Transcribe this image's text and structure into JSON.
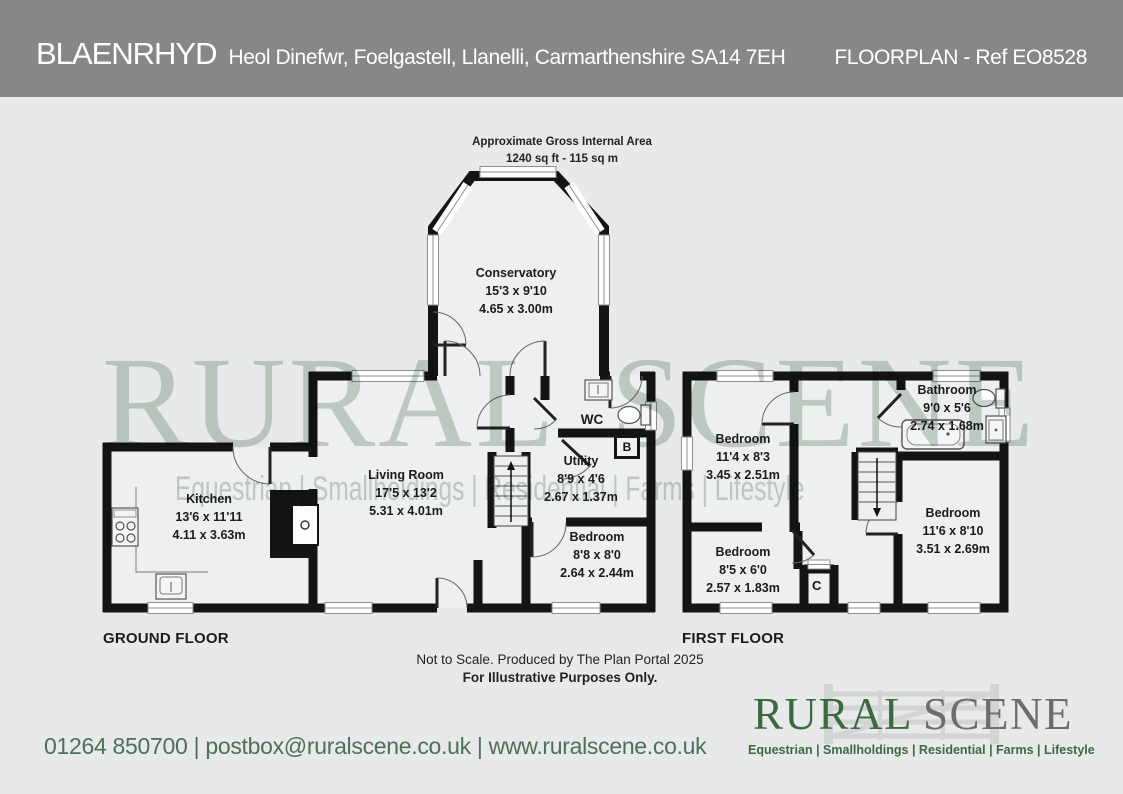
{
  "header": {
    "property_name": "BLAENRHYD",
    "address": "Heol Dinefwr, Foelgastell, Llanelli, Carmarthenshire SA14 7EH",
    "floorplan_ref": "FLOORPLAN - Ref EO8528"
  },
  "area_summary": {
    "line1": "Approximate Gross Internal Area",
    "line2": "1240 sq ft - 115 sq m"
  },
  "floor_labels": {
    "ground": "GROUND FLOOR",
    "first": "FIRST FLOOR"
  },
  "rooms": {
    "conservatory": {
      "name": "Conservatory",
      "imperial": "15'3 x 9'10",
      "metric": "4.65 x 3.00m"
    },
    "kitchen": {
      "name": "Kitchen",
      "imperial": "13'6 x 11'11",
      "metric": "4.11 x 3.63m"
    },
    "living_room": {
      "name": "Living Room",
      "imperial": "17'5 x 13'2",
      "metric": "5.31 x 4.01m"
    },
    "wc": {
      "name": "WC"
    },
    "utility": {
      "name": "Utility",
      "imperial": "8'9 x 4'6",
      "metric": "2.67 x 1.37m"
    },
    "bedroom_ground": {
      "name": "Bedroom",
      "imperial": "8'8 x 8'0",
      "metric": "2.64 x 2.44m"
    },
    "bedroom_one": {
      "name": "Bedroom",
      "imperial": "11'4 x 8'3",
      "metric": "3.45 x 2.51m"
    },
    "bathroom": {
      "name": "Bathroom",
      "imperial": "9'0 x 5'6",
      "metric": "2.74 x 1.68m"
    },
    "bedroom_two": {
      "name": "Bedroom",
      "imperial": "8'5 x 6'0",
      "metric": "2.57 x 1.83m"
    },
    "bedroom_three": {
      "name": "Bedroom",
      "imperial": "11'6 x 8'10",
      "metric": "3.51 x 2.69m"
    }
  },
  "markers": {
    "boiler": "B",
    "cupboard": "C"
  },
  "disclaimer": {
    "line1": "Not to Scale. Produced by The Plan Portal 2025",
    "line2": "For Illustrative Purposes Only."
  },
  "watermark": {
    "title": "RURAL SCENE",
    "tagline": "Equestrian | Smallholdings | Residential | Farms | Lifestyle"
  },
  "footer": {
    "contact": "01264 850700 | postbox@ruralscene.co.uk | www.ruralscene.co.uk",
    "logo": {
      "word_primary": "RURAL",
      "word_secondary": "SCENE",
      "tagline": "Equestrian | Smallholdings | Residential | Farms | Lifestyle"
    }
  },
  "colors": {
    "header_bg": "#878787",
    "page_bg": "#e8e9eb",
    "wall": "#141414",
    "room_fill": "#edeff0",
    "watermark_green": "#8fa894",
    "logo_green": "#3c6a40",
    "logo_gray": "#6d6d6f",
    "contact_green": "#4d7157"
  }
}
